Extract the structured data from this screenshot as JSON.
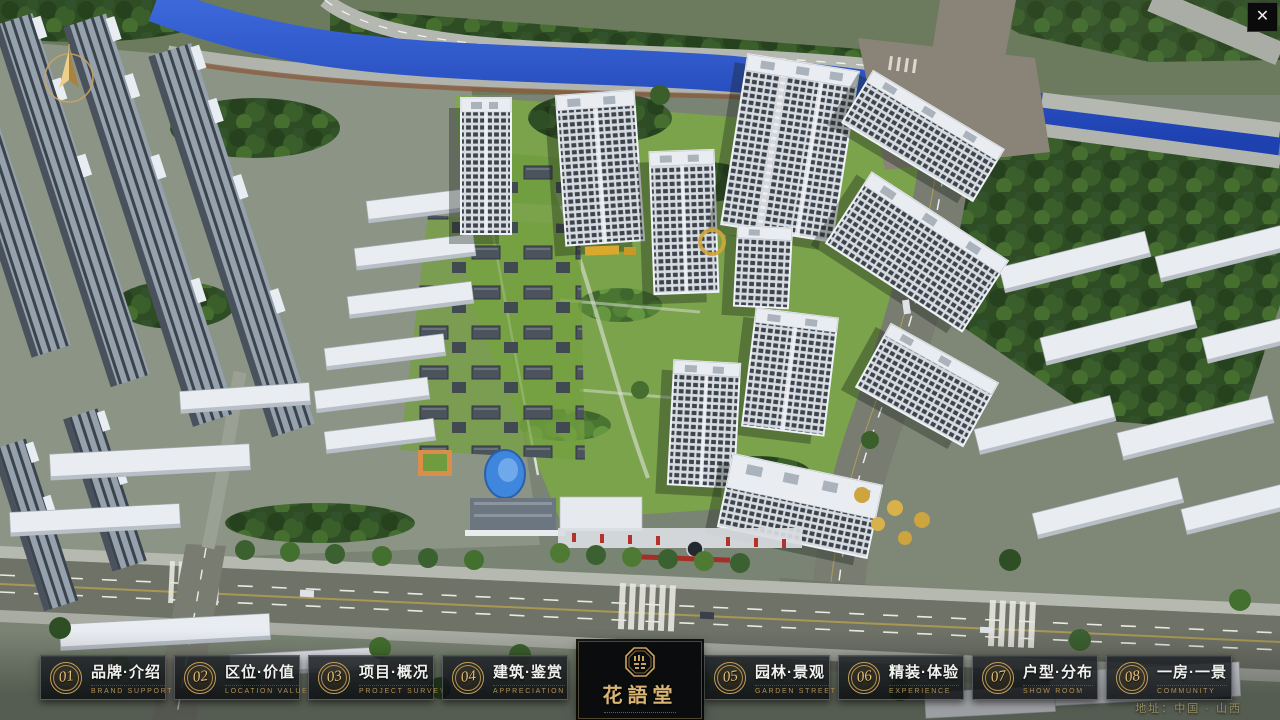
{
  "window": {
    "close_glyph": "✕"
  },
  "logo": {
    "title": "花語堂"
  },
  "footer": {
    "address": "地址：中国 · 山西"
  },
  "icons": {
    "close": "close-x",
    "compass": "north-arrow-compass",
    "seal": "octagonal-gold-seal"
  },
  "nav": {
    "items": [
      {
        "number": "01",
        "title": "品牌·介绍",
        "subtitle": "BRAND SUPPORT"
      },
      {
        "number": "02",
        "title": "区位·价值",
        "subtitle": "LOCATION VALUE"
      },
      {
        "number": "03",
        "title": "项目·概况",
        "subtitle": "PROJECT SURVEY"
      },
      {
        "number": "04",
        "title": "建筑·鉴赏",
        "subtitle": "APPRECIATION"
      },
      {
        "number": "05",
        "title": "园林·景观",
        "subtitle": "GARDEN STREET"
      },
      {
        "number": "06",
        "title": "精装·体验",
        "subtitle": "EXPERIENCE"
      },
      {
        "number": "07",
        "title": "户型·分布",
        "subtitle": "SHOW ROOM"
      },
      {
        "number": "08",
        "title": "一房·一景",
        "subtitle": "COMMUNITY"
      }
    ]
  }
}
